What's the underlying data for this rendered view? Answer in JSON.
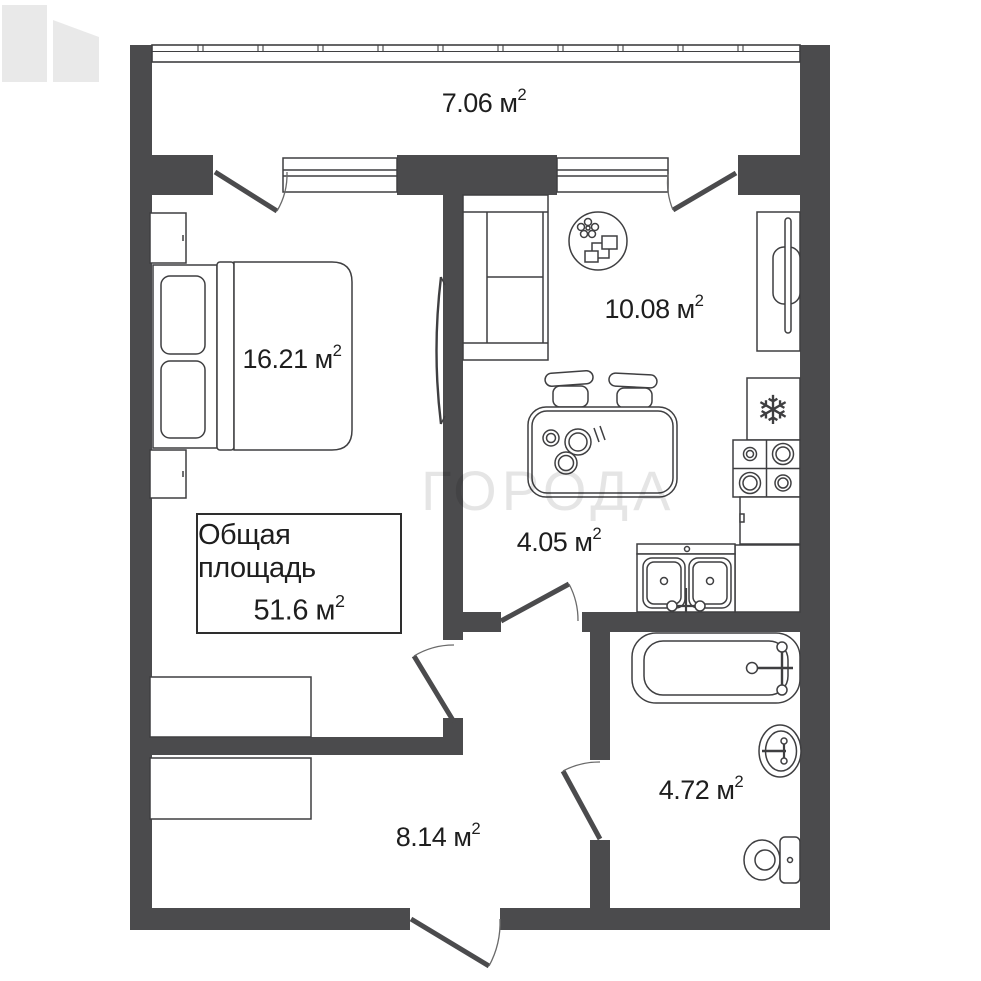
{
  "floorplan": {
    "watermark": {
      "text": "ГОРОДА"
    },
    "total": {
      "line1": "Общая площадь",
      "value": "51.6",
      "unit": "м",
      "sup": "2"
    },
    "rooms": {
      "balcony": {
        "value": "7.06",
        "unit": "м",
        "sup": "2"
      },
      "bedroom": {
        "value": "16.21",
        "unit": "м",
        "sup": "2"
      },
      "kitchen": {
        "value": "10.08",
        "unit": "м",
        "sup": "2"
      },
      "hall": {
        "value": "4.05",
        "unit": "м",
        "sup": "2"
      },
      "corridor": {
        "value": "8.14",
        "unit": "м",
        "sup": "2"
      },
      "bathroom": {
        "value": "4.72",
        "unit": "м",
        "sup": "2"
      }
    },
    "icons": {
      "snowflake": "❄"
    },
    "colors": {
      "wall": "#4b4b4d",
      "line": "#3f3f41",
      "watermark": "#e7e7e7"
    }
  }
}
